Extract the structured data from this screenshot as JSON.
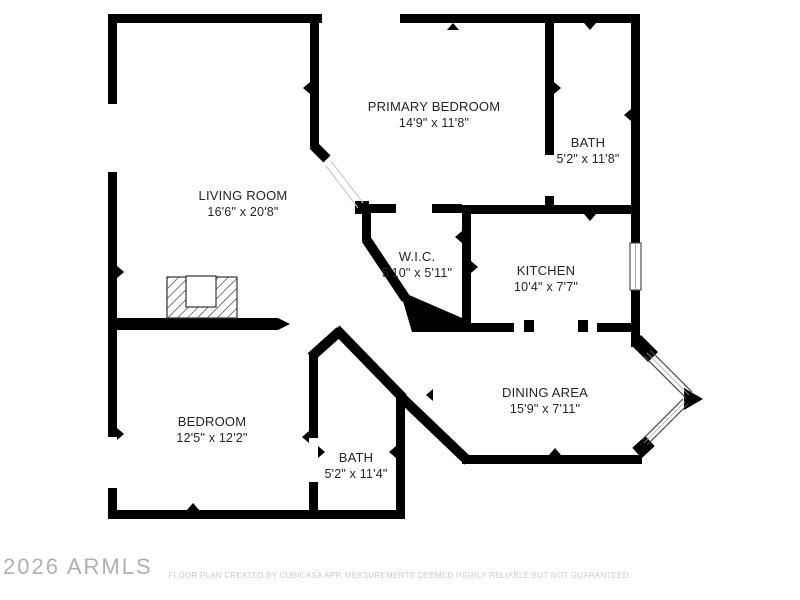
{
  "rooms": [
    {
      "name": "PRIMARY BEDROOM",
      "dimensions": "14'9\" x 11'8\""
    },
    {
      "name": "BATH",
      "dimensions": "5'2\" x 11'8\""
    },
    {
      "name": "LIVING ROOM",
      "dimensions": "16'6\" x 20'8\""
    },
    {
      "name": "W.I.C.",
      "dimensions": "5'10\" x 5'11\""
    },
    {
      "name": "KITCHEN",
      "dimensions": "10'4\" x 7'7\""
    },
    {
      "name": "DINING AREA",
      "dimensions": "15'9\" x 7'11\""
    },
    {
      "name": "BEDROOM",
      "dimensions": "12'5\" x 12'2\""
    },
    {
      "name": "BATH",
      "dimensions": "5'2\" x 11'4\""
    }
  ],
  "watermark": "2026 ARMLS",
  "disclaimer": "FLOOR PLAN CREATED BY CUBICASA APP. MEASUREMENTS DEEMED HIGHLY RELIABLE BUT NOT GUARANTEED.",
  "colors": {
    "wall": "#000000",
    "background": "#ffffff",
    "label_text": "#252525",
    "watermark_text": "#b0b0b0",
    "disclaimer_text": "#cbcbcb"
  }
}
